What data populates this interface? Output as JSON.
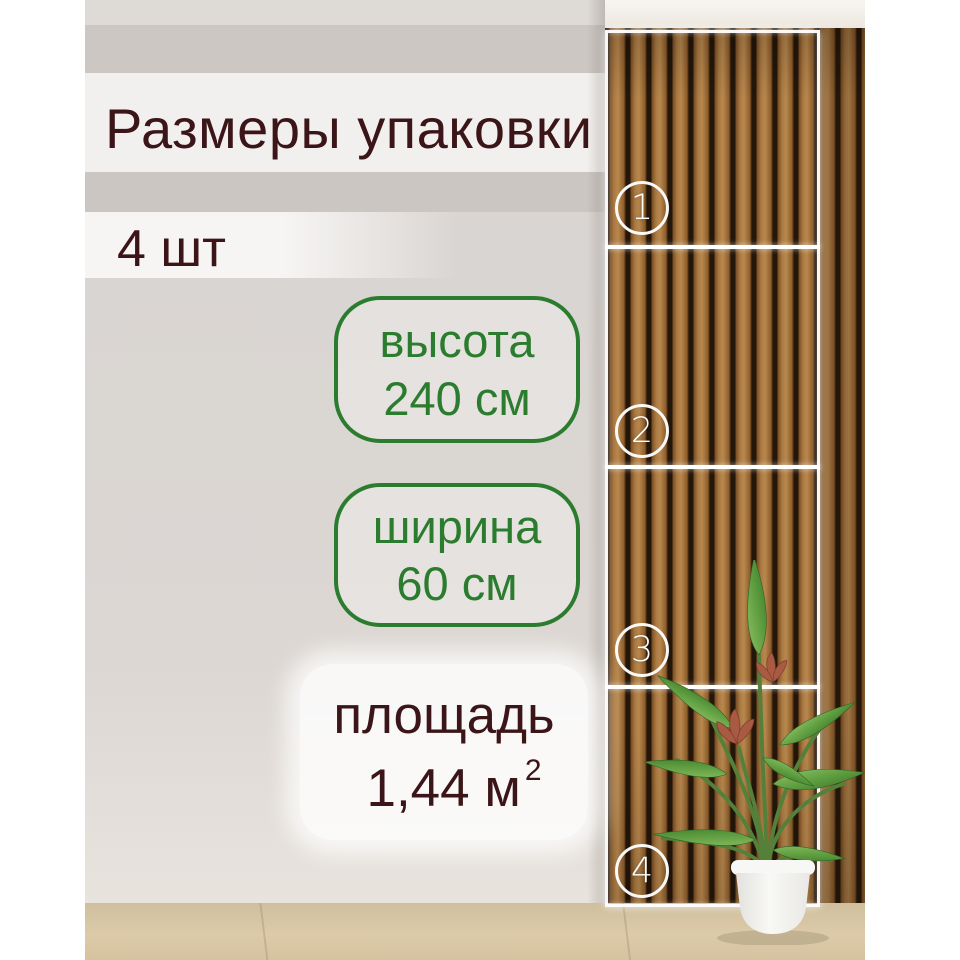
{
  "title": "Размеры упаковки",
  "quantity": "4 шт",
  "dimensions": {
    "height": {
      "label": "высота",
      "value": "240 см"
    },
    "width": {
      "label": "ширина",
      "value": "60 см"
    }
  },
  "area": {
    "label": "площадь",
    "value": "1,44 м",
    "superscript": "2"
  },
  "panel": {
    "sections": {
      "s1": "1",
      "s2": "2",
      "s3": "3",
      "s4": "4"
    }
  },
  "colors": {
    "text_maroon": "#3c1518",
    "accent_green": "#2b7c2e",
    "marker_white": "#ffffff",
    "wood_brown": "#9a6632",
    "floor_beige": "#d9c8a7"
  }
}
